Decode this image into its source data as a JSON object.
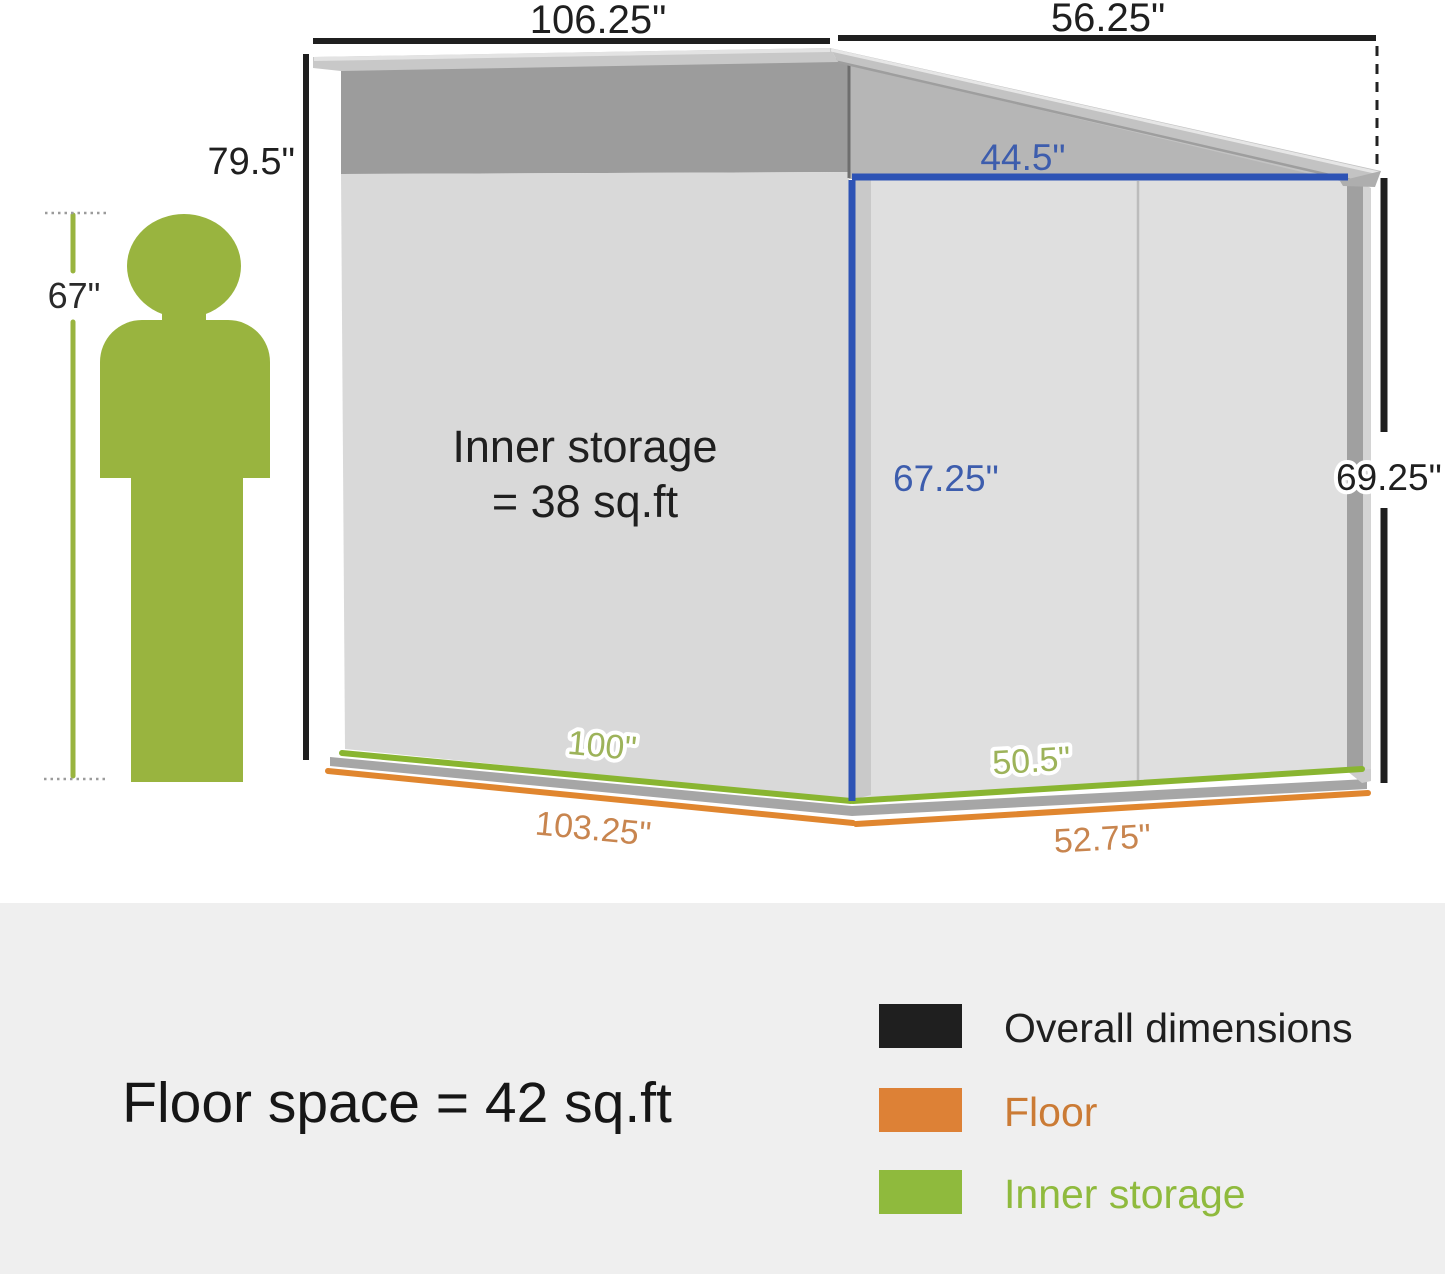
{
  "title": "Storage shed dimension diagram",
  "colors": {
    "black": "#1f1f1f",
    "blue": "#2d53b5",
    "green_line": "#89b531",
    "orange_line": "#e0862f",
    "person_green": "#99b43f",
    "footer_bg": "#efefef"
  },
  "dimensions": {
    "overall_side_width": "106.25\"",
    "overall_front_width": "56.25\"",
    "overall_height_left": "79.5\"",
    "overall_height_right": "69.25\"",
    "person_height": "67\"",
    "inner_front_width": "44.5\"",
    "inner_height": "67.25\"",
    "inner_side_length": "100\"",
    "inner_front_length": "50.5\"",
    "floor_side_length": "103.25\"",
    "floor_front_length": "52.75\""
  },
  "annotations": {
    "inner_storage_line1": "Inner storage",
    "inner_storage_line2": "= 38 sq.ft"
  },
  "footer": {
    "floor_space": "Floor space = 42 sq.ft",
    "legend": [
      {
        "label": "Overall dimensions",
        "color": "#1f1f1f"
      },
      {
        "label": "Floor",
        "color": "#dd8136"
      },
      {
        "label": "Inner storage",
        "color": "#8fba3d"
      }
    ]
  }
}
